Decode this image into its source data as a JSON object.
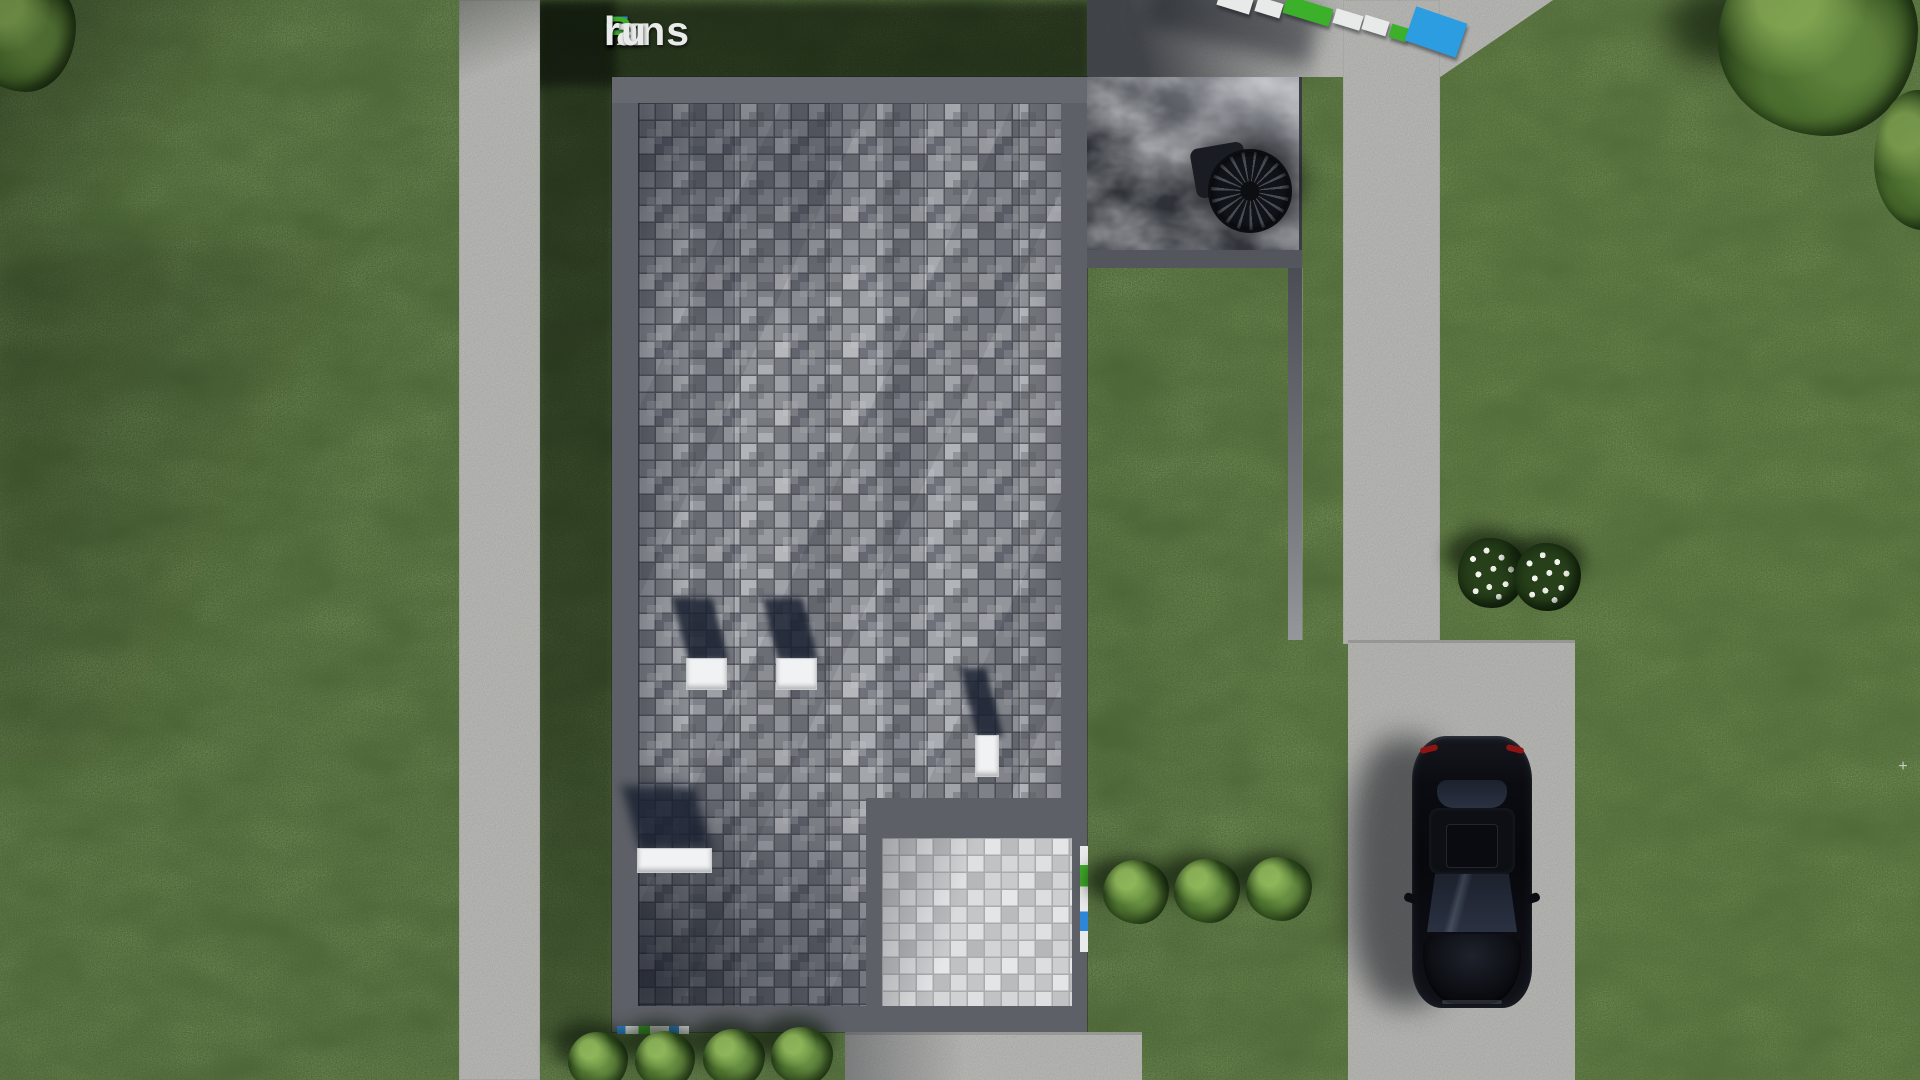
{
  "watermark": {
    "text": "FixPlans.ru",
    "segments": [
      {
        "text": "F",
        "color": "blue"
      },
      {
        "text": "ix",
        "color": "white"
      },
      {
        "text": "P",
        "color": "green"
      },
      {
        "text": "lans",
        "color": "white"
      },
      {
        "text": ".",
        "color": "blue"
      },
      {
        "text": "ru",
        "color": "white"
      }
    ]
  },
  "brand_colors": {
    "blue": "#2e86d8",
    "green": "#3fae2a",
    "white": "#e9eaea"
  },
  "palette": {
    "grass": "#425928",
    "grassShadow": "#1d2c14",
    "concrete": "#c7c8c4",
    "driveway": "#c4c5c1",
    "roofBorder": "#5d6066",
    "paverGap": "#595c63",
    "porchPaver": "#cfd1d2",
    "marbleDark": "#202329",
    "marbleLight": "#9a9da3",
    "carBody": "#0a0c10",
    "tailLight": "#8e1414"
  },
  "scene": {
    "objects": [
      "paved flat roof",
      "dark marble roof terrace",
      "spiral staircase",
      "white roof vents",
      "lower paved porch",
      "black sedan on driveway",
      "concrete walkways",
      "lawn",
      "green bushes",
      "white flower shrubs"
    ]
  }
}
